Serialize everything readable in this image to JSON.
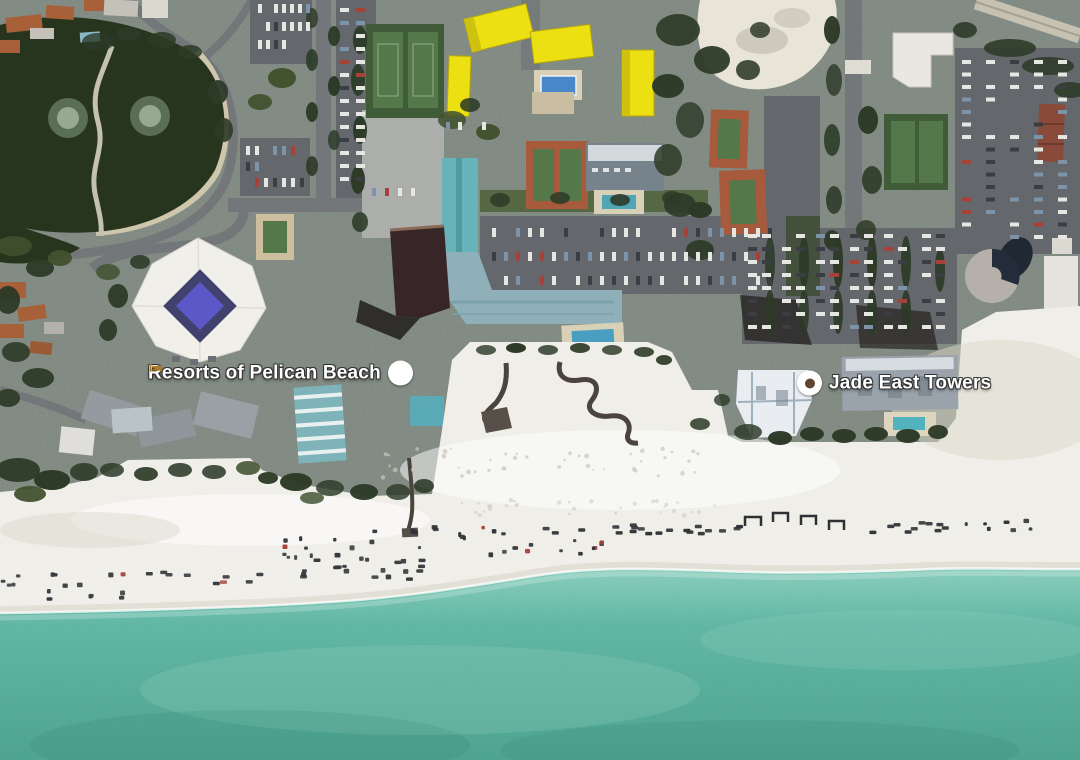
{
  "map": {
    "view": "satellite",
    "description": "Aerial satellite view of a beachfront resort strip with white sand beach and turquoise gulf water",
    "labels": [
      {
        "text": "Resorts of Pelican Beach",
        "icon": "lodging-icon",
        "icon_side": "right"
      },
      {
        "text": "Jade East Towers",
        "icon": "poi-dot-icon",
        "icon_side": "left"
      }
    ],
    "palette": {
      "land_base": "#878b84",
      "pond": "#27351f",
      "road": "#73777a",
      "parking": "#64686c",
      "sand": "#efeee8",
      "vegetation_dark": "#2c3a27",
      "vegetation_mid": "#41522f",
      "building_yellow": "#ecdf12",
      "roof_teal": "#66b4ba",
      "roof_slate": "#8fb0b9",
      "clay_court": "#a85a3c",
      "court_green": "#54784a",
      "pool_blue": "#4a87c8",
      "pool_violet": "#5d58c8",
      "ocean_shallow": "#8ccfbd",
      "ocean_mid": "#5bb4a1",
      "ocean_deep": "#47a08c",
      "label_text": "#ffffff",
      "lodging_glyph": "#b07c22",
      "poi_dot": "#5f4632"
    }
  }
}
